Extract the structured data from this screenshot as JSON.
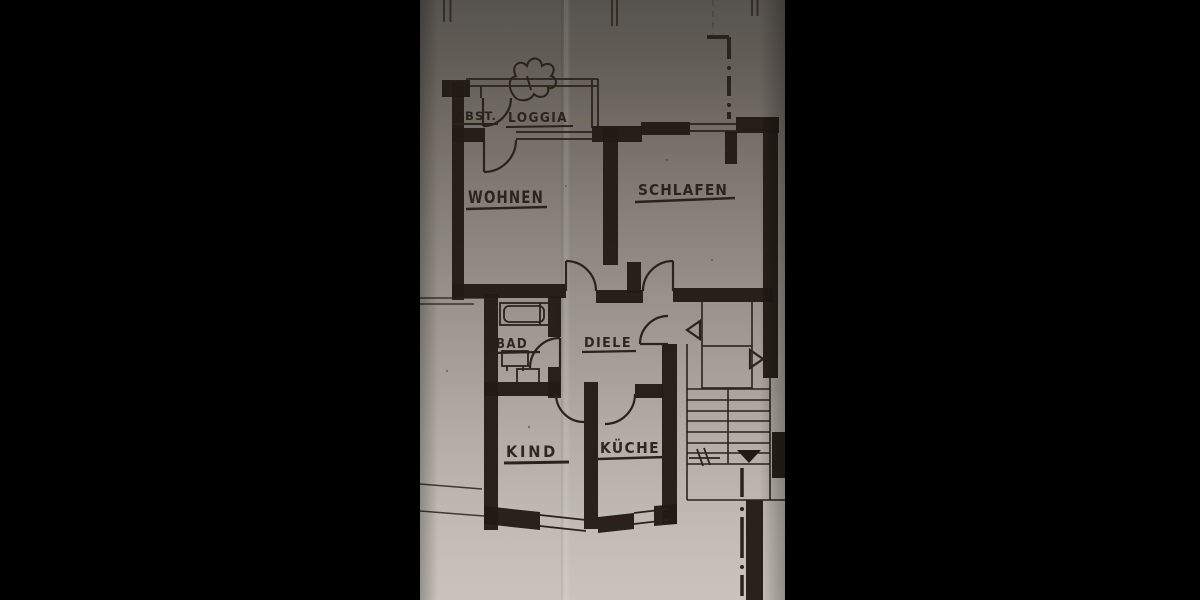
{
  "scene": {
    "letterbox_color": "#000000",
    "paper_color_top": "#635d57",
    "paper_color_bottom": "#c9c3bb",
    "ink_color": "#221b14"
  },
  "floor_plan": {
    "rooms": [
      {
        "id": "abst",
        "label": "ABST."
      },
      {
        "id": "loggia",
        "label": "LOGGIA"
      },
      {
        "id": "wohnen",
        "label": "WOHNEN"
      },
      {
        "id": "schlafen",
        "label": "SCHLAFEN"
      },
      {
        "id": "bad",
        "label": "BAD"
      },
      {
        "id": "diele",
        "label": "DIELE"
      },
      {
        "id": "kind",
        "label": "KIND"
      },
      {
        "id": "kueche",
        "label": "KÜCHE"
      }
    ],
    "symbols": [
      "plant-squiggle-icon",
      "door-swing-arc",
      "window-opening",
      "bathtub-icon",
      "washbasin-icon",
      "wc-icon",
      "staircase-icon",
      "stair-direction-arrow",
      "section-dash-dot-line",
      "dimension-tick"
    ]
  }
}
